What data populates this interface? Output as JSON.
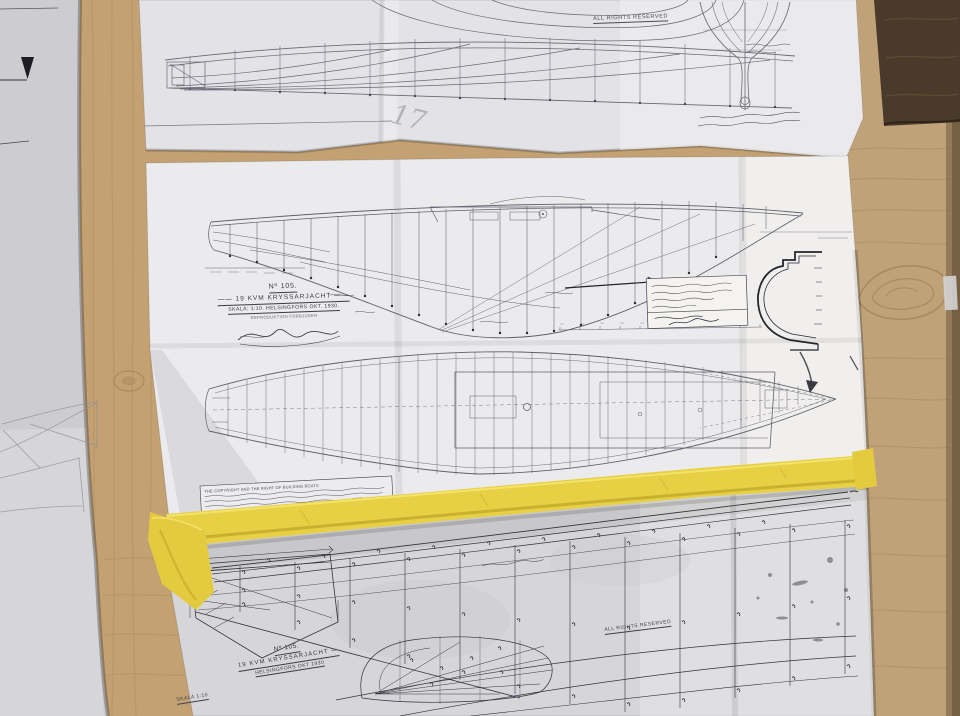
{
  "top_sheet": {
    "rights_notice": "ALL RIGHTS RESERVED",
    "pencil_mark": "17"
  },
  "middle_sheet": {
    "drawing_number": "Nº 105.",
    "title": "—— 19 KVM  KRYSSARJACHT ——",
    "scale_line": "SKALA: 1:10.   HELSINGFORS OKT. 1930.",
    "repro_line": "REPRODUKTION FÖRBJUDEN",
    "fine_print_first_line": "THE COPYRIGHT AND THE RIGHT OF BUILDING BOATS"
  },
  "bottom_sheet": {
    "drawing_number": "Nº 105.",
    "title": "19 KVM  KRYSSARJACHT —",
    "date_line": "HELSINGFORS OKT 1930",
    "scale_label": "SKALA 1:10",
    "rights_notice": "ALL RIGHTS RESERVED"
  },
  "colors": {
    "plywood": "#c9aa7e",
    "dark_wood_corner": "#4a3a2b",
    "masking_tape": "#e8d044",
    "paper_white": "#e9e9ec",
    "paper_grey": "#d7d7da",
    "drawing_ink": "#5f5f6a",
    "print_ink": "#33333d"
  }
}
